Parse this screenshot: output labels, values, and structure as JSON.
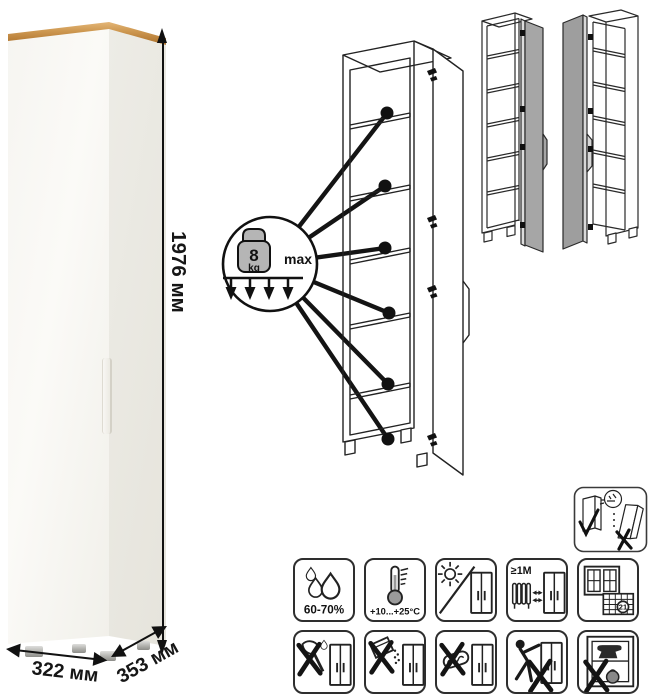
{
  "dimensions": {
    "height": "1976 мм",
    "width": "322 мм",
    "depth": "353 мм"
  },
  "shelf_load": {
    "value": "8",
    "unit": "kg",
    "qualifier": "max"
  },
  "care": {
    "humidity": "60-70%",
    "temperature": "+10...+25°C",
    "min_distance": "≥1М",
    "airing_days": "21"
  },
  "icons": {
    "row1": [
      "humidity-icon",
      "temperature-icon",
      "no-direct-sunlight-icon",
      "heat-source-distance-icon",
      "ventilation-days-icon"
    ],
    "row2": [
      "no-sharp-tools-icon",
      "no-abrasive-powder-icon",
      "no-scouring-pad-icon",
      "no-dragging-icon",
      "no-overload-icon"
    ],
    "standalone": [
      "anchor-to-wall-icon"
    ]
  },
  "views": {
    "photo": "tall-white-cabinet-with-oak-top",
    "diagram": "open-cabinet-shelf-load-diagram",
    "variants": [
      "door-hinged-right",
      "door-hinged-left"
    ]
  },
  "colors": {
    "wood_top": "#bf8a45",
    "cabinet_white": "#f7f6f2",
    "door_gray": "#a6a6a6",
    "line": "#1d1d1d"
  }
}
